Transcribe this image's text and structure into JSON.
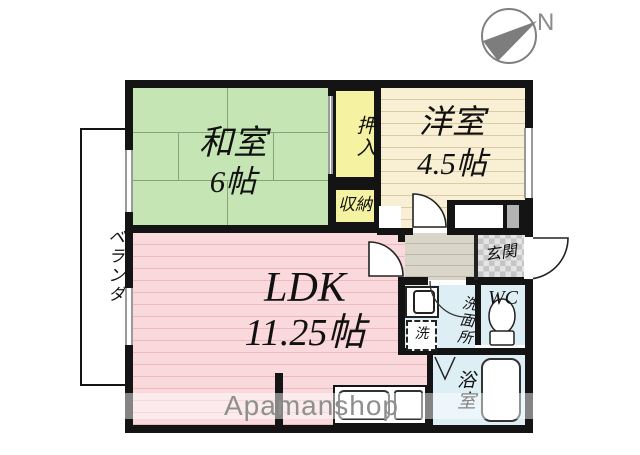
{
  "compass": {
    "label": "N"
  },
  "watermark": {
    "text": "Apamanshop"
  },
  "rooms": {
    "washitsu": {
      "name": "和室",
      "size": "6帖"
    },
    "yoshitsu": {
      "name": "洋室",
      "size": "4.5帖"
    },
    "ldk": {
      "name": "LDK",
      "size": "11.25帖"
    },
    "oshiire": {
      "label": "押入"
    },
    "shuno": {
      "label": "収納"
    },
    "veranda": {
      "label": "ベランダ"
    },
    "genkan": {
      "label": "玄関"
    },
    "wc": {
      "label": "WC"
    },
    "senmenjo": {
      "label": "洗面所"
    },
    "laundry": {
      "label": "洗"
    },
    "yokushitsu": {
      "label": "浴室"
    }
  },
  "colors": {
    "tatami_green": "#c6e5b5",
    "western_cream": "#f8efd4",
    "ldk_pink": "#f9d9db",
    "wet_blue": "#ddeef5",
    "closet_yellow": "#f5f3a2",
    "hall_gray": "#d9d6c9",
    "wall_black": "#141414"
  }
}
